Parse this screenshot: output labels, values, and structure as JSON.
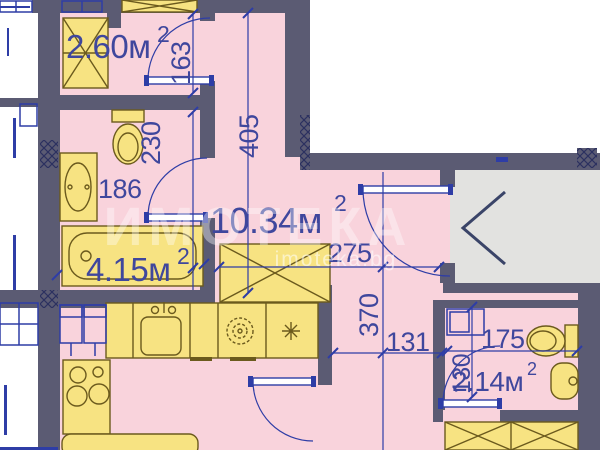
{
  "floor_plan": {
    "description": "apartment floor plan drawing",
    "rooms": [
      {
        "name": "storage-room",
        "area": "2.60м",
        "sup": "2"
      },
      {
        "name": "hallway",
        "area": "10.34м",
        "sup": "2"
      },
      {
        "name": "bathroom",
        "area": "4.15м",
        "sup": "2"
      },
      {
        "name": "wc",
        "area": "2.14м",
        "sup": "2"
      }
    ],
    "dimensions": {
      "v163": "163",
      "v405": "405",
      "v230": "230",
      "v186": "186",
      "v275": "275",
      "v370": "370",
      "v131": "131",
      "v175": "175",
      "v130": "130"
    },
    "watermark": {
      "brand": "ИМОТЕКА",
      "site": "imoteka.bg"
    },
    "colors": {
      "wall": "#5b5b73",
      "room_fill": "#f9d3dc",
      "fixture_fill": "#f7e382",
      "fixture_stroke": "#6b5a1d",
      "line_blue": "#2e3da6",
      "label_blue": "#3f479d",
      "corridor_fill": "#e2e2e0",
      "outside": "#ffffff"
    },
    "icons": [
      "shower-cabinet-icon",
      "toilet-icon",
      "pedestal-sink-icon",
      "bathtub-icon",
      "kitchen-sink-icon",
      "stove-icon",
      "washing-machine-icon",
      "appliance-asterisk-icon",
      "wardrobe-icon",
      "entry-direction-chevron-icon",
      "window-icon",
      "door-arc-icon"
    ]
  }
}
